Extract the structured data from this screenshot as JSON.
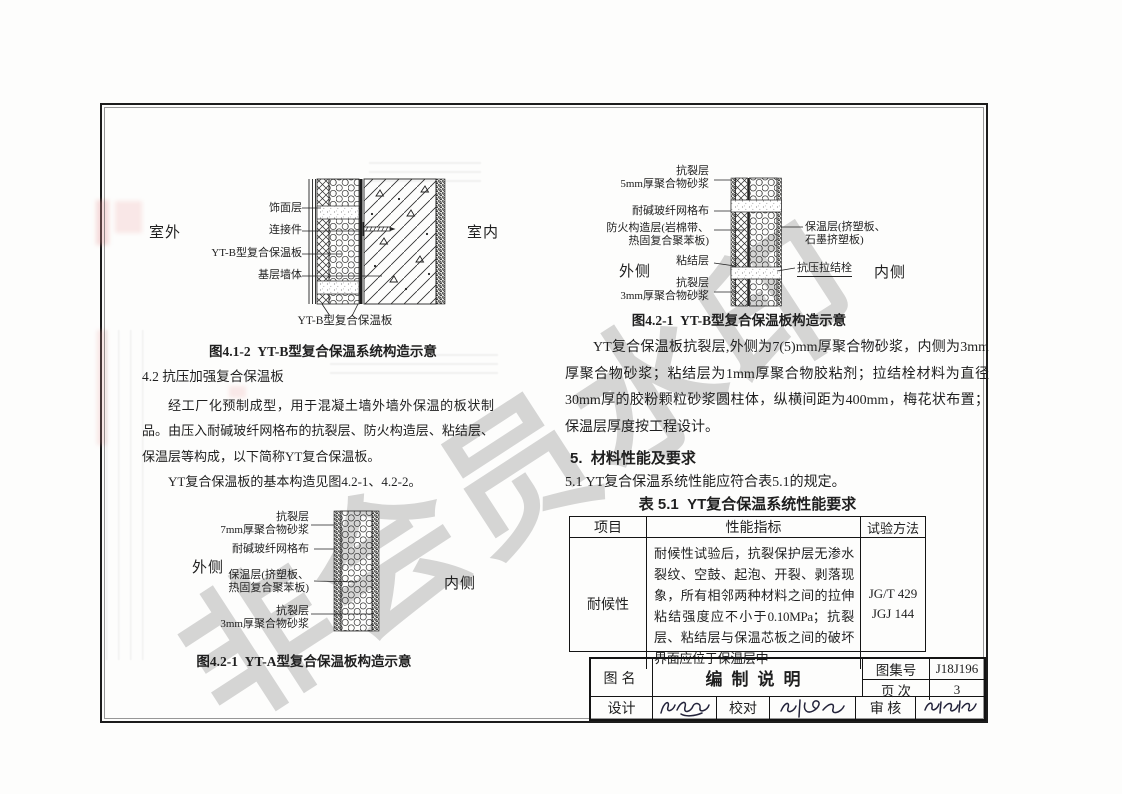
{
  "colors": {
    "ink": "#1f1f1f",
    "watermark": "#c6c6c6",
    "bleed_pink": "#e9a0a0"
  },
  "watermark": {
    "text": "非会员水印"
  },
  "figure_yt_b_system": {
    "caption": "图4.1-2  YT-B型复合保温系统构造示意",
    "side_left": "室外",
    "side_right": "室内",
    "labels": [
      "饰面层",
      "连接件",
      "YT-B型复合保温板",
      "基层墙体"
    ],
    "bottom_label": "YT-B型复合保温板"
  },
  "section_4_2": {
    "heading": "4.2 抗压加强复合保温板",
    "para_1": "经工厂化预制成型，用于混凝土墙外墙外保温的板状制品。由压入耐碱玻纤网格布的抗裂层、防火构造层、粘结层、保温层等构成，以下简称YT复合保温板。",
    "para_2": "YT复合保温板的基本构造见图4.2-1、4.2-2。"
  },
  "figure_yt_a_board": {
    "caption": "图4.2-1  YT-A型复合保温板构造示意",
    "side_left": "外侧",
    "side_right": "内侧",
    "labels": [
      "抗裂层\n7mm厚聚合物砂浆",
      "耐碱玻纤网格布",
      "保温层(挤塑板、\n热固复合聚苯板)",
      "抗裂层\n3mm厚聚合物砂浆"
    ]
  },
  "figure_yt_b_board": {
    "caption": "图4.2-1  YT-B型复合保温板构造示意",
    "side_left": "外侧",
    "side_right": "内侧",
    "labels_left": [
      "抗裂层\n5mm厚聚合物砂浆",
      "耐碱玻纤网格布",
      "防火构造层(岩棉带、\n热固复合聚苯板)",
      "粘结层",
      "抗裂层\n3mm厚聚合物砂浆"
    ],
    "labels_right": [
      "保温层(挤塑板、\n石墨挤塑板)",
      "抗压拉结栓"
    ]
  },
  "paragraph_right": "YT复合保温板抗裂层,外侧为7(5)mm厚聚合物砂浆，内侧为3mm厚聚合物砂浆；粘结层为1mm厚聚合物胶粘剂；拉结栓材料为直径30mm厚的胶粉颗粒砂浆圆柱体，纵横间距为400mm，梅花状布置；保温层厚度按工程设计。",
  "section_5": {
    "heading": "5.  材料性能及要求",
    "clause_5_1": "5.1 YT复合保温系统性能应符合表5.1的规定。"
  },
  "table_5_1": {
    "title": "表 5.1  YT复合保温系统性能要求",
    "col_item": "项目",
    "col_indicator": "性能指标",
    "col_method": "试验方法",
    "row_item": "耐候性",
    "row_indicator": "耐候性试验后，抗裂保护层无渗水裂纹、空鼓、起泡、开裂、剥落现象，所有相邻两种材料之间的拉伸粘结强度应不小于0.10MPa；抗裂层、粘结层与保温芯板之间的破坏界面应位于保温层中",
    "row_method": "JG/T 429\nJGJ 144"
  },
  "title_block": {
    "fig_name_label": "图名",
    "fig_name": "编制说明",
    "atlas_label": "图集号",
    "atlas_no": "J18J196",
    "page_label": "页 次",
    "page_no": "3",
    "design_label": "设计",
    "proof_label": "校对",
    "review_label": "审 核"
  }
}
